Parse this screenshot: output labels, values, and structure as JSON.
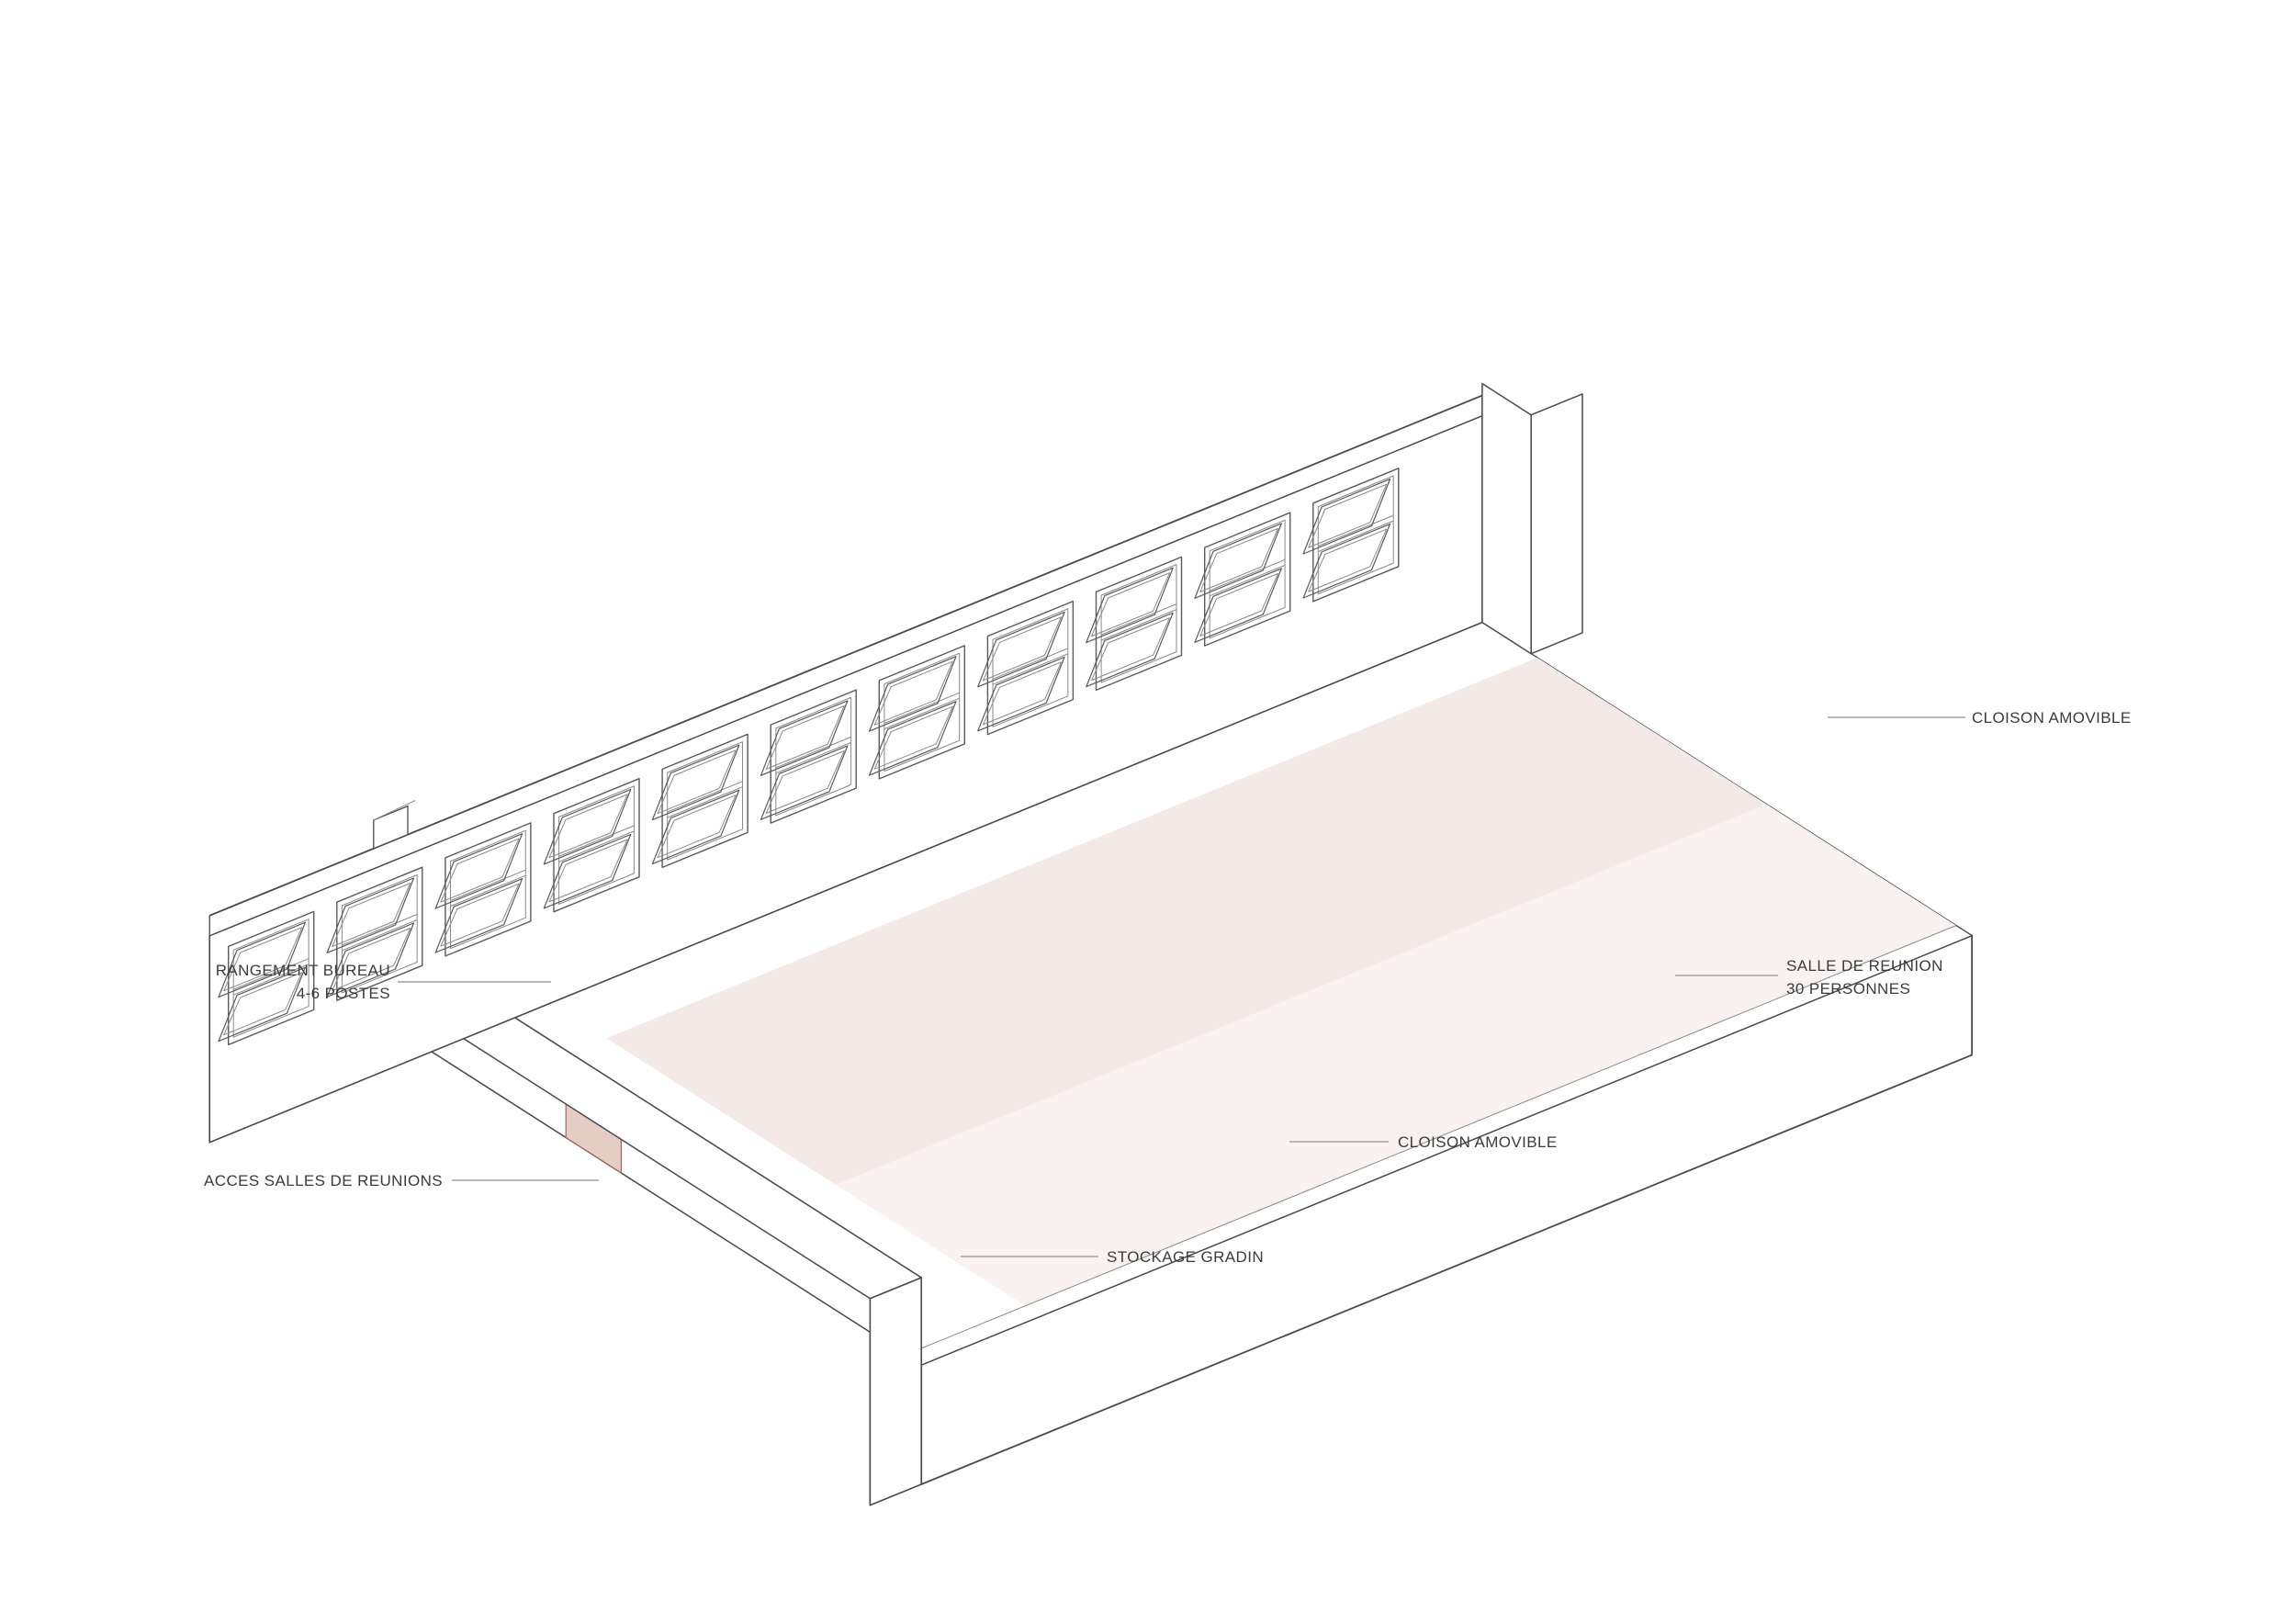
{
  "diagram": {
    "title": "Axonometrie salle de reunion modulable",
    "type": "axonometric-architecture-cutaway",
    "language": "fr",
    "labels": {
      "cloison_top": {
        "lines": [
          "CLOISON AMOVIBLE"
        ]
      },
      "rangement": {
        "lines": [
          "RANGEMENT BUREAU",
          "4-6 POSTES"
        ]
      },
      "acces": {
        "lines": [
          "ACCES SALLES DE REUNIONS"
        ]
      },
      "salle": {
        "lines": [
          "SALLE DE REUNION",
          "30 PERSONNES"
        ]
      },
      "cloison_bottom": {
        "lines": [
          "CLOISON AMOVIBLE"
        ]
      },
      "stockage": {
        "lines": [
          "STOCKAGE GRADIN"
        ]
      }
    },
    "colors": {
      "background": "#ffffff",
      "line": "#4a4a4a",
      "line_soft": "#8a8a8a",
      "partition_grid": "#a5685e",
      "partition_cap": "#8d4c40",
      "dashed_track": "#9c4b3c",
      "pink_solid": "#e2c6be",
      "pink_face": "#e9d1ca",
      "pink_side": "#f0ded8",
      "pink_top": "#f6eae6",
      "door_pink": "#e5cdc6",
      "floor_room": "#f4e9e6",
      "floor_front": "#f9f2f0",
      "figure_stroke": "#7a7a7a",
      "leader": "#9f9f9f",
      "text": "#3b3b3b"
    }
  }
}
